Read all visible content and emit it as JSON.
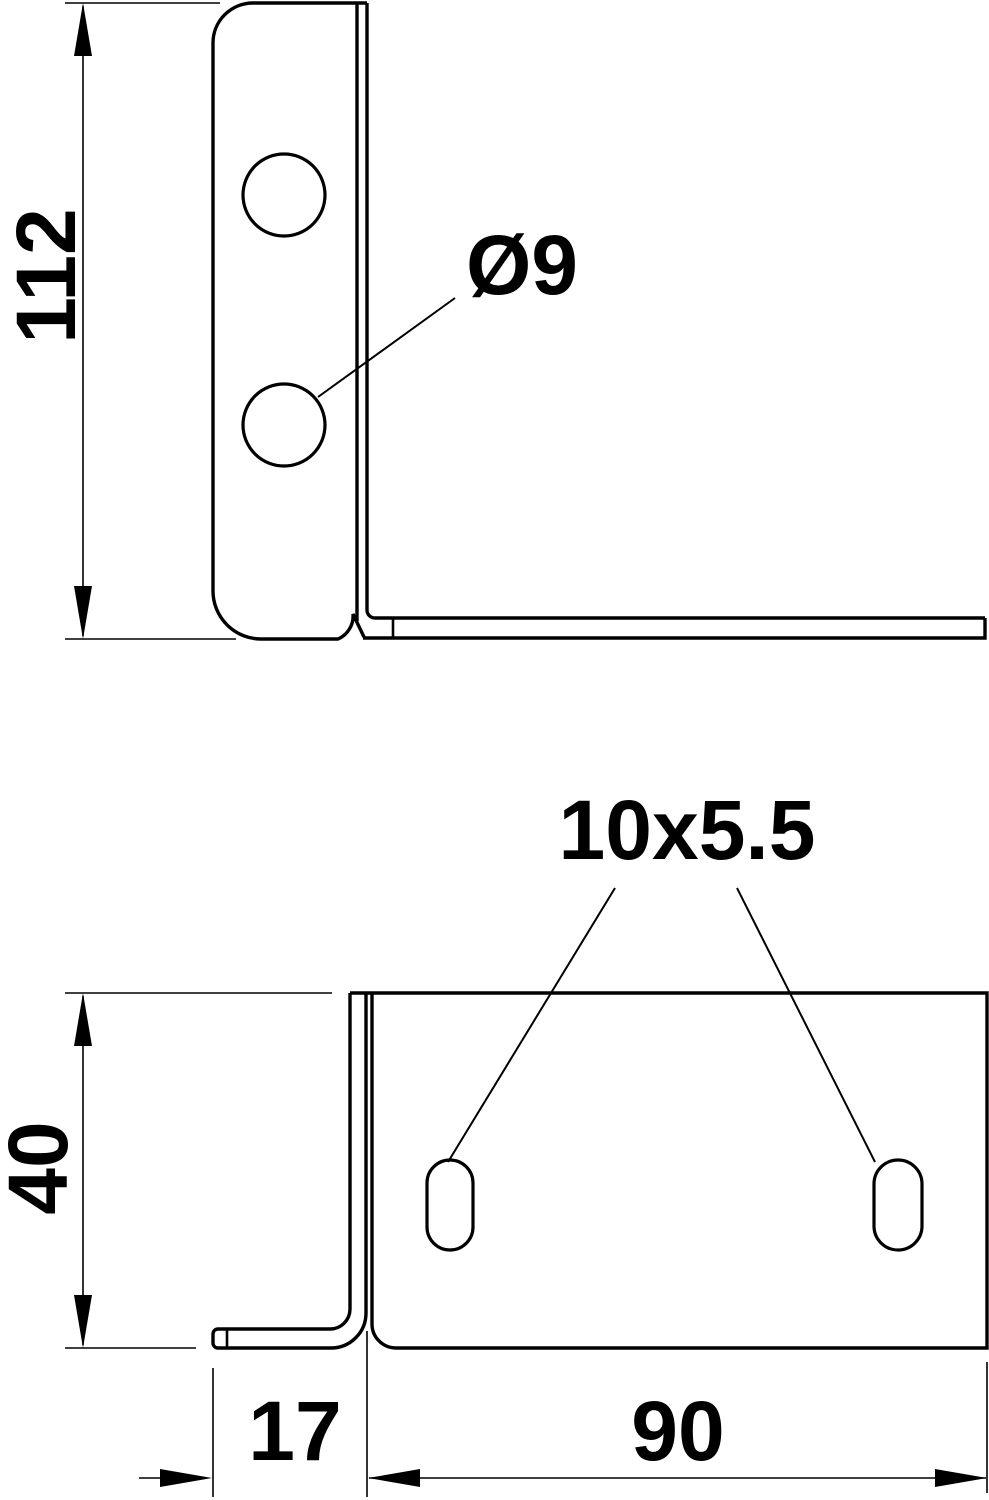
{
  "drawing": {
    "kind": "technical-drawing",
    "subject": "L-shaped sheet-metal mounting bracket, two orthographic views",
    "colors": {
      "line": "#000000",
      "background": "#ffffff",
      "text": "#000000"
    },
    "side_view": {
      "dim_height": "112",
      "hole_diameter_label": "Ø9",
      "hole_count": 2
    },
    "front_view": {
      "dim_height": "40",
      "dim_leg_width": "17",
      "dim_plate_width": "90",
      "slot_size_label": "10x5.5",
      "slot_count": 2
    }
  }
}
